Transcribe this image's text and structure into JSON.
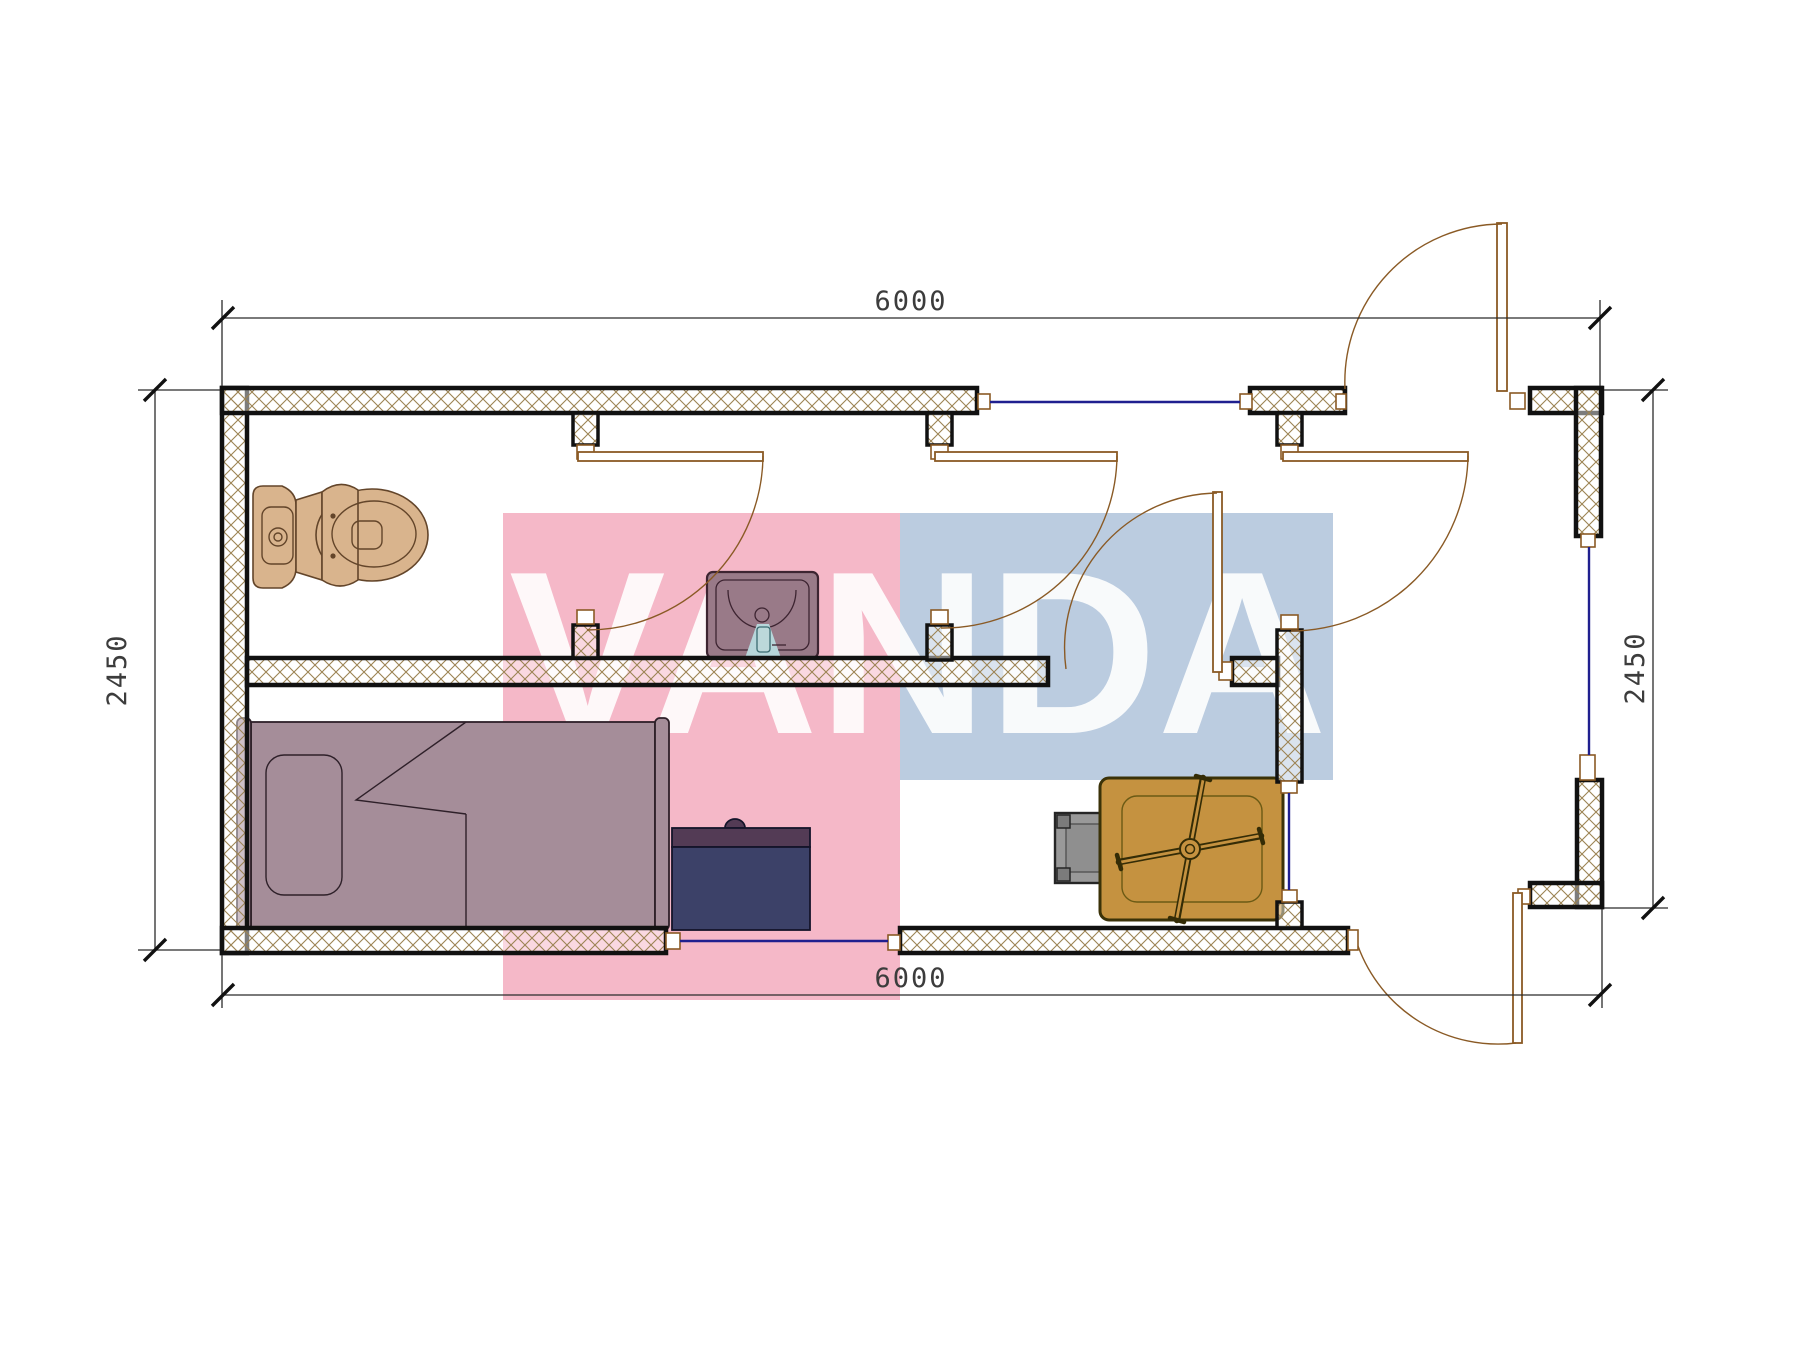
{
  "drawing": {
    "type": "architectural floor plan (container house 6000 x 2450)",
    "units": "mm",
    "overall_width_mm": 6000,
    "overall_height_mm": 2450,
    "dimensions": {
      "top": "6000",
      "bottom": "6000",
      "left": "2450",
      "right": "2450"
    },
    "watermark": {
      "text": "VANDA"
    },
    "rooms": [
      "toilet room",
      "washroom",
      "hall",
      "entrance vestibule",
      "bedroom"
    ],
    "furniture": [
      "toilet",
      "wash basin",
      "single bed",
      "desk",
      "stool",
      "table with fan"
    ],
    "features": [
      "4 windows",
      "2 exterior doors",
      "4 interior doors",
      "insulated hatched walls"
    ]
  },
  "colors": {
    "hatch": "#9c8353",
    "wood": "#8a5a25",
    "window": "#1f1f8f",
    "pink": "rgba(242,164,185,0.78)",
    "blue": "rgba(164,187,214,0.75)",
    "toilet": "#d9b48d",
    "bed": "#a58d99",
    "sink": "#997a88",
    "desk": "#3c4168",
    "table": "#c59240"
  }
}
